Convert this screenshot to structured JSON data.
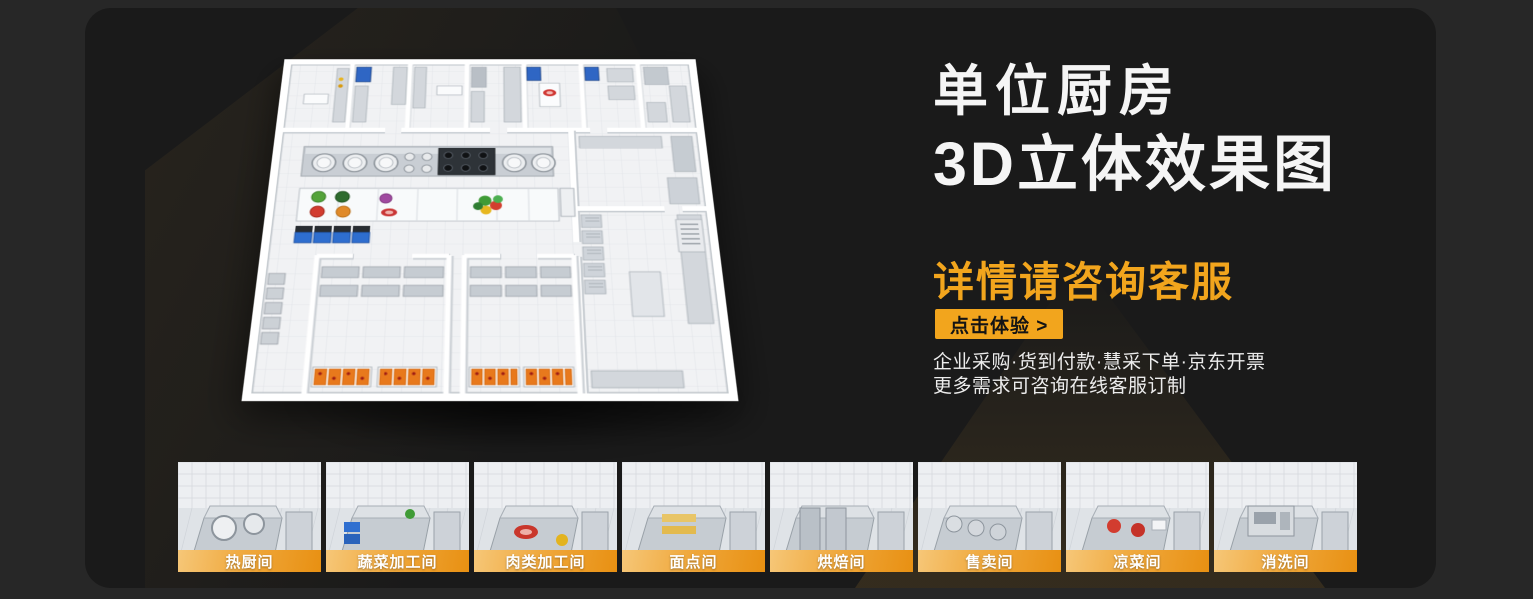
{
  "page": {
    "outer_bg": "#272727",
    "card_bg": "#1a1a1a"
  },
  "hero": {
    "title_line1": "单位厨房",
    "title_line2": "3D立体效果图",
    "subtitle": "详情请咨询客服",
    "cta_label": "点击体验 >",
    "desc_line1": "企业采购·货到付款·慧采下单·京东开票",
    "desc_line2": "更多需求可咨询在线客服订制",
    "accent_color": "#F2A51D"
  },
  "floorplan": {
    "description": "3D isometric rendering of a unit kitchen floor plan"
  },
  "thumbnails": [
    {
      "label": "热厨间"
    },
    {
      "label": "蔬菜加工间"
    },
    {
      "label": "肉类加工间"
    },
    {
      "label": "面点间"
    },
    {
      "label": "烘焙间"
    },
    {
      "label": "售卖间"
    },
    {
      "label": "凉菜间"
    },
    {
      "label": "消洗间"
    }
  ]
}
